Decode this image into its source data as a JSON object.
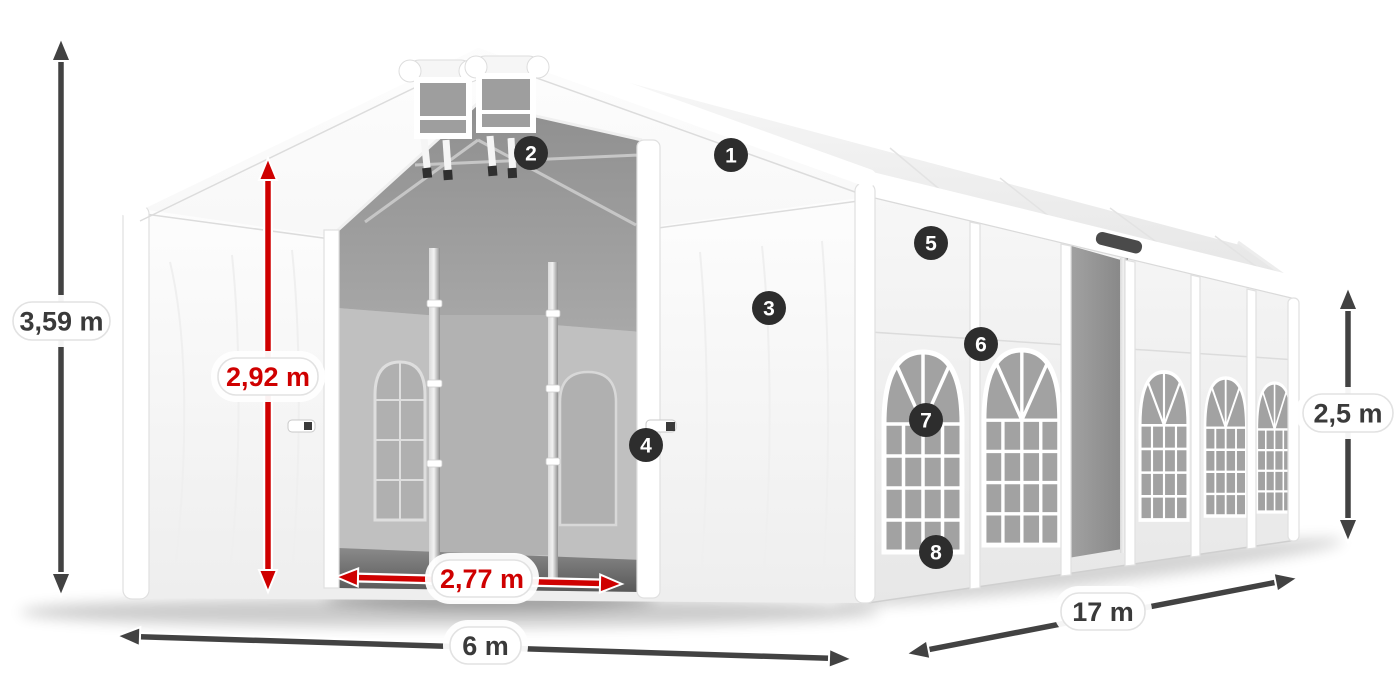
{
  "dimensions": {
    "total_height": "3,59 m",
    "entrance_height": "2,92 m",
    "entrance_width": "2,77 m",
    "width": "6 m",
    "length": "17 m",
    "side_height": "2,5 m"
  },
  "callouts": [
    "1",
    "2",
    "3",
    "4",
    "5",
    "6",
    "7",
    "8"
  ],
  "colors": {
    "dimension_arrow": "#424242",
    "accent_red": "#cf0000",
    "badge_background": "#2d2d2d",
    "badge_text": "#ffffff",
    "label_background": "#ffffff",
    "label_border": "#e2e2e2",
    "tent_white": "#fbfbfb",
    "interior_gray": "#a6a6a6"
  }
}
